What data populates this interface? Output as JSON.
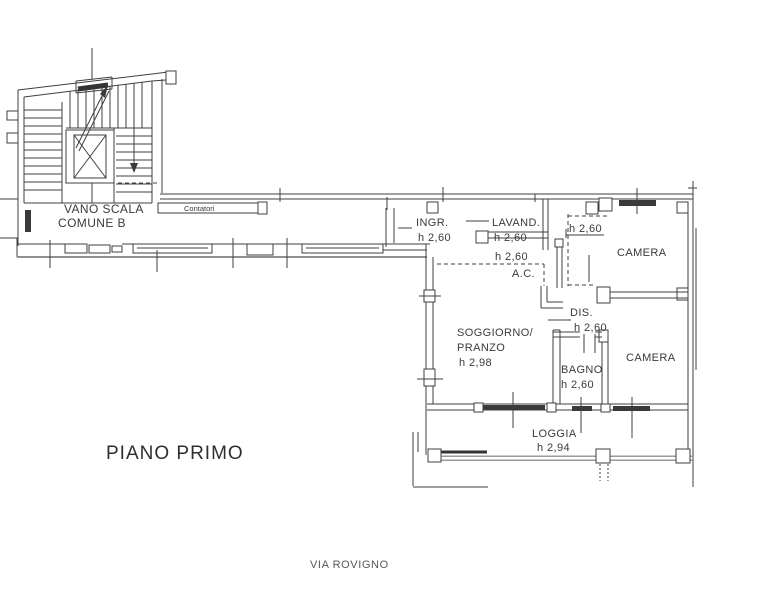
{
  "plan": {
    "title": "PIANO PRIMO",
    "street": "VIA ROVIGNO"
  },
  "common": {
    "stairwell_line1": "VANO SCALA",
    "stairwell_line2": "COMUNE B",
    "meters_label": "Contatori"
  },
  "rooms": {
    "ingresso": {
      "name": "INGR.",
      "height": "h 2,60"
    },
    "lavanderia": {
      "name": "LAVAND.",
      "height": "h 2,60"
    },
    "armadio": {
      "name": "A.C.",
      "height": "h 2,60"
    },
    "vestibolo": {
      "height": "h 2,60"
    },
    "camera_nord": {
      "name": "CAMERA"
    },
    "soggiorno": {
      "name_line1": "SOGGIORNO/",
      "name_line2": "PRANZO",
      "height": "h 2,98"
    },
    "disimpegno": {
      "name": "DIS.",
      "height": "h 2,60"
    },
    "bagno": {
      "name": "BAGNO",
      "height": "h 2,60"
    },
    "camera_sud": {
      "name": "CAMERA"
    },
    "loggia": {
      "name": "LOGGIA",
      "height": "h 2,94"
    }
  },
  "colors": {
    "background": "#ffffff",
    "line": "#3f3f3f",
    "exterior_gray": "#8f8f8f",
    "text": "#3a3a3a"
  }
}
